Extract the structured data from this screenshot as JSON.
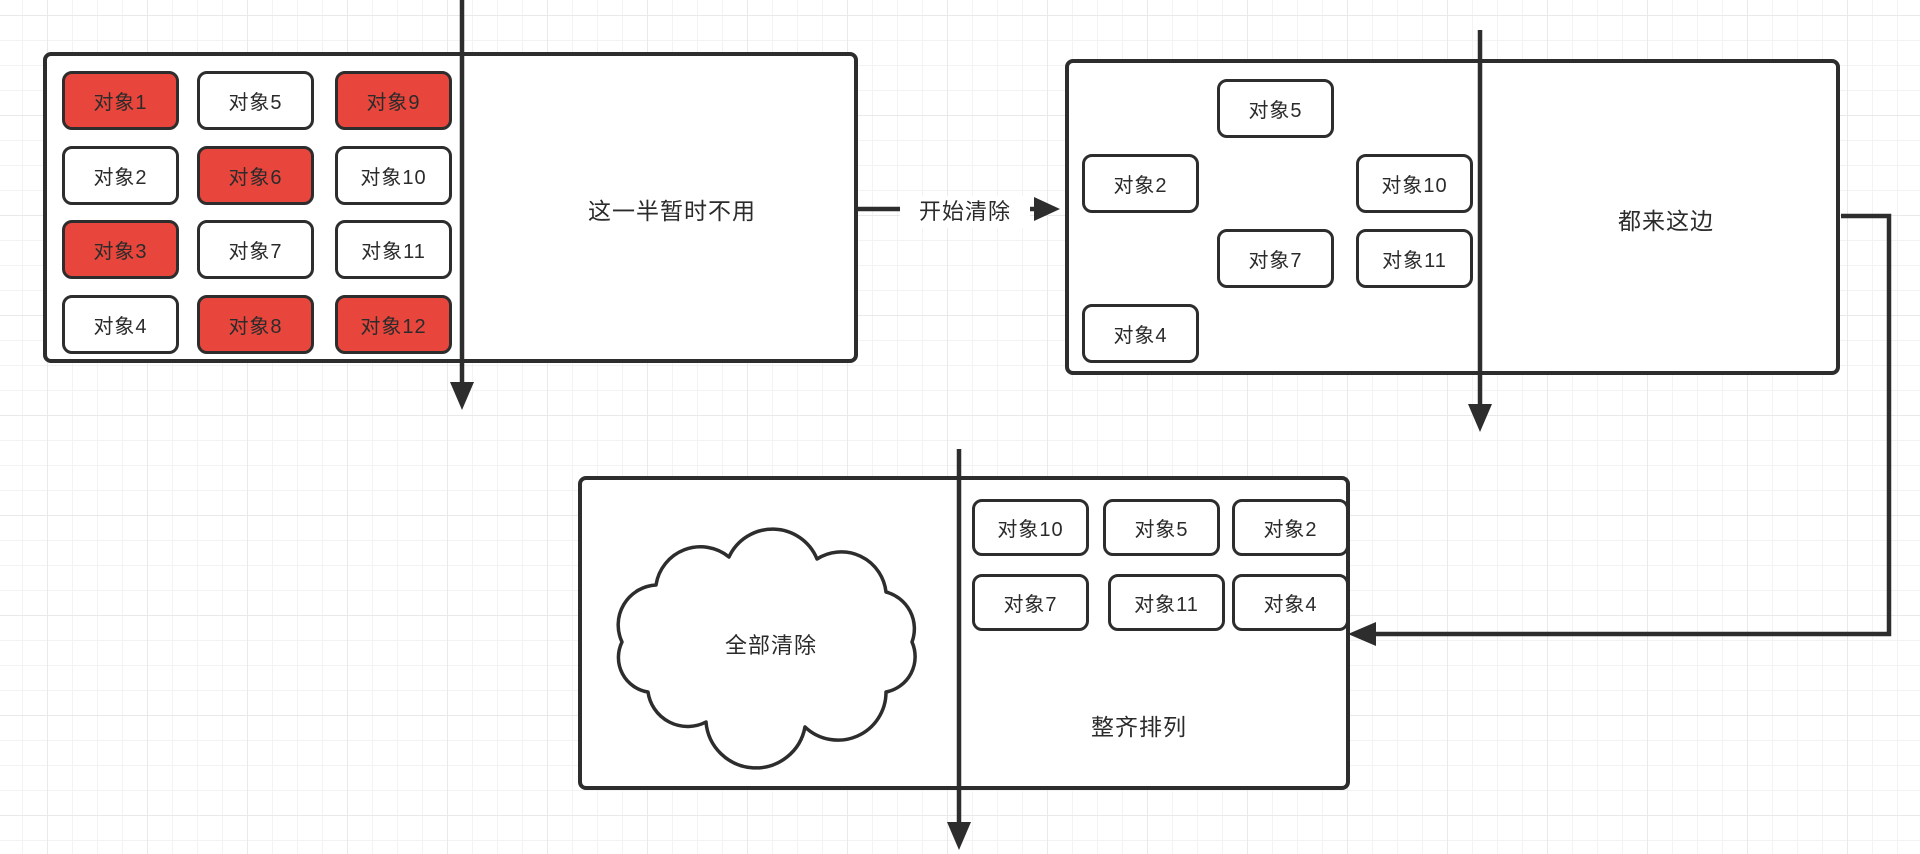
{
  "diagram_title": "mark-compact-gc-diagram",
  "colors": {
    "stroke": "#2d2d2d",
    "text": "#2b2b2b",
    "red_fill": "#e8463c",
    "white_fill": "#ffffff",
    "bg": "#ffffff",
    "grid_minor": "#f3f3f4",
    "grid_major": "#e9e9ea"
  },
  "heap_left": {
    "caption": "这一半暂时不用",
    "objects": [
      {
        "label": "对象1",
        "state": "red"
      },
      {
        "label": "对象5",
        "state": "white"
      },
      {
        "label": "对象9",
        "state": "red"
      },
      {
        "label": "对象2",
        "state": "white"
      },
      {
        "label": "对象6",
        "state": "red"
      },
      {
        "label": "对象10",
        "state": "white"
      },
      {
        "label": "对象3",
        "state": "red"
      },
      {
        "label": "对象7",
        "state": "white"
      },
      {
        "label": "对象11",
        "state": "white"
      },
      {
        "label": "对象4",
        "state": "white"
      },
      {
        "label": "对象8",
        "state": "red"
      },
      {
        "label": "对象12",
        "state": "red"
      }
    ]
  },
  "transfer_arrow": {
    "label": "开始清除"
  },
  "heap_right": {
    "caption": "都来这边",
    "objects": [
      {
        "label": "对象5"
      },
      {
        "label": "对象2"
      },
      {
        "label": "对象10"
      },
      {
        "label": "对象7"
      },
      {
        "label": "对象11"
      },
      {
        "label": "对象4"
      }
    ]
  },
  "compact_box": {
    "cloud_label": "全部清除",
    "caption": "整齐排列",
    "objects": [
      {
        "label": "对象10"
      },
      {
        "label": "对象5"
      },
      {
        "label": "对象2"
      },
      {
        "label": "对象7"
      },
      {
        "label": "对象11"
      },
      {
        "label": "对象4"
      }
    ]
  }
}
